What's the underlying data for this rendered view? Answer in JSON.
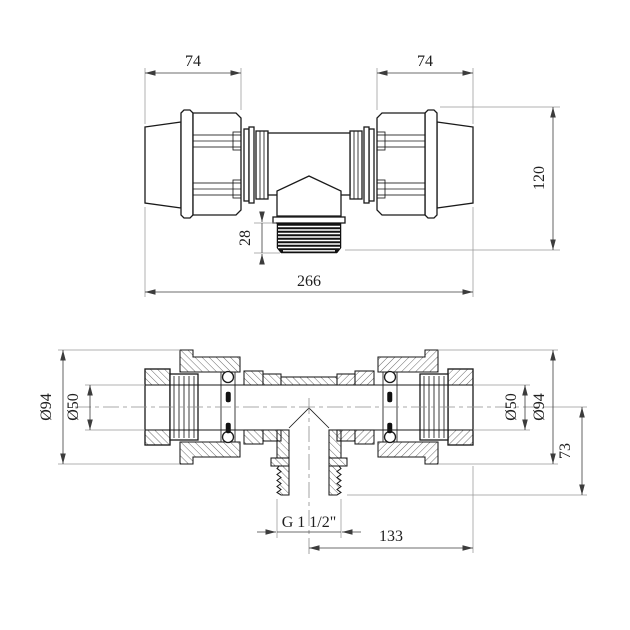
{
  "drawing": {
    "colors": {
      "line": "#1a1a1a",
      "dimension": "#3c3c3c",
      "extension": "#979797",
      "background": "#ffffff"
    },
    "front_view": {
      "dims": {
        "cap_left": "74",
        "cap_right": "74",
        "overall_height": "120",
        "thread_length": "28",
        "overall_length": "266"
      }
    },
    "section_view": {
      "dims": {
        "od_left": "Ø94",
        "bore_left": "Ø50",
        "bore_right": "Ø50",
        "od_right": "Ø94",
        "outlet_drop": "73",
        "outlet_offset": "133",
        "thread_spec": "G 1 1/2\""
      }
    }
  }
}
